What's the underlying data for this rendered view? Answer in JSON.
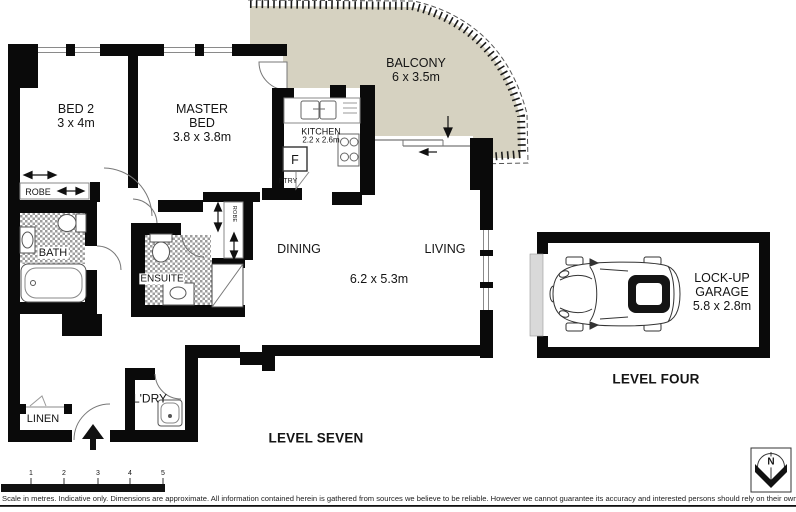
{
  "rooms": {
    "bed2": {
      "name": "BED 2",
      "dims": "3 x 4m"
    },
    "master": {
      "name": "MASTER BED",
      "dims": "3.8 x 3.8m"
    },
    "balcony": {
      "name": "BALCONY",
      "dims": "6 x 3.5m"
    },
    "kitchen": {
      "name": "KITCHEN",
      "dims": "2.2 x 2.6m"
    },
    "dining": {
      "name": "DINING"
    },
    "living": {
      "name": "LIVING"
    },
    "living_dining_dims": "6.2 x 5.3m",
    "ensuite": {
      "name": "ENSUITE"
    },
    "bath": {
      "name": "BATH"
    },
    "robe_bed2": {
      "name": "ROBE"
    },
    "robe_master": {
      "name": "ROBE"
    },
    "pantry": {
      "name": "PTRY"
    },
    "fridge": {
      "name": "F"
    },
    "laundry": {
      "name": "L'DRY"
    },
    "linen": {
      "name": "LINEN"
    },
    "garage": {
      "name": "LOCK-UP GARAGE",
      "dims": "5.8 x 2.8m"
    }
  },
  "levels": {
    "apartment": "LEVEL SEVEN",
    "garage": "LEVEL FOUR"
  },
  "compass": {
    "north_label": "N"
  },
  "scale_bar": {
    "ticks": [
      "1",
      "2",
      "3",
      "4",
      "5"
    ]
  },
  "footer": {
    "disclaimer": "Scale in metres. Indicative only. Dimensions are approximate. All information contained herein is gathered from sources we believe to be reliable. However we cannot guarantee its accuracy and interested persons should rely on their own enquiries."
  },
  "colors": {
    "balcony_fill": "#d6d2c1",
    "wall": "#0a0a0a",
    "garage_door": "#d9d9d9"
  }
}
